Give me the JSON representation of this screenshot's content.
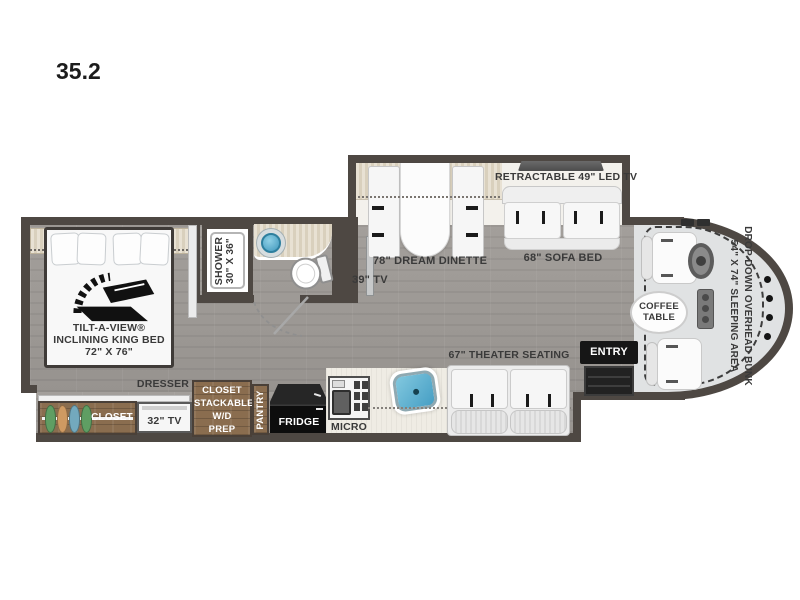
{
  "title": "35.2",
  "colors": {
    "wall": "#4e4843",
    "floor": "#a09c98",
    "slide_floor": "#f3f1ec",
    "valance_beige": "#e0d8c6",
    "cab_floor": "#e0e2e3",
    "wood": "#8a6d4f",
    "counter_cream": "#efece4",
    "appliance_black": "#161616",
    "sink_blue": "#5cb6d4",
    "label_dark": "#3a3a3a",
    "label_light": "#ffffff"
  },
  "bedroom": {
    "bed_line1": "TILT-A-VIEW®",
    "bed_line2": "INCLINING KING BED",
    "bed_line3": "72\" X 76\"",
    "dresser": "DRESSER",
    "closet": "CLOSET",
    "tv": "32\" TV",
    "wd_line1": "CLOSET",
    "wd_line2": "STACKABLE",
    "wd_line3": "W/D",
    "wd_line4": "PREP"
  },
  "bathroom": {
    "shower_line1": "SHOWER",
    "shower_line2": "30\" X 36\""
  },
  "hallway": {
    "tv": "39\" TV"
  },
  "kitchen": {
    "pantry": "PANTRY",
    "fridge": "FRIDGE",
    "micro": "MICRO"
  },
  "living": {
    "dinette": "78\" DREAM DINETTE",
    "retractable_tv": "RETRACTABLE 49\" LED TV",
    "sofa": "68\" SOFA BED",
    "theater": "67\" THEATER SEATING"
  },
  "entry": {
    "label": "ENTRY"
  },
  "cab": {
    "coffee_line1": "COFFEE",
    "coffee_line2": "TABLE",
    "bunk_line1": "DROP-DOWN OVERHEAD BUNK",
    "bunk_line2": "54\" X 74\" SLEEPING AREA"
  }
}
